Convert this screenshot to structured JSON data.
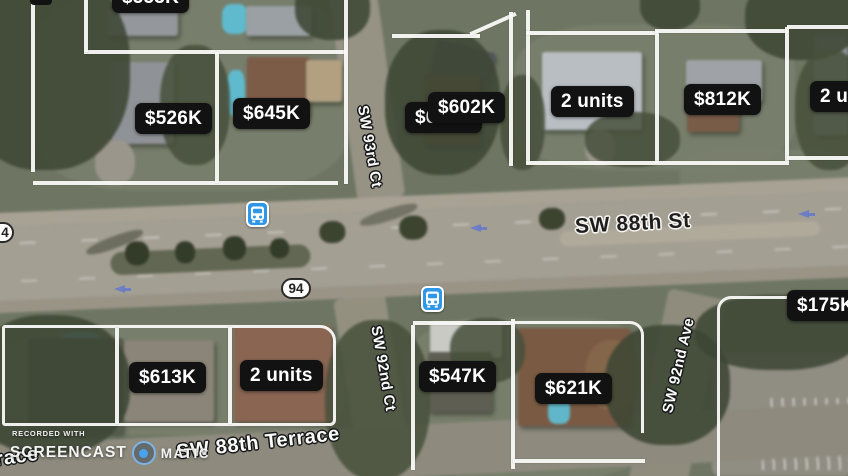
{
  "app": {
    "description": "real-estate satellite map with listing price pins"
  },
  "price_labels": [
    {
      "text": "$553K"
    },
    {
      "text": "$526K"
    },
    {
      "text": "$645K"
    },
    {
      "text": "$600K"
    },
    {
      "text": "$602K"
    },
    {
      "text": "2 units"
    },
    {
      "text": "$812K"
    },
    {
      "text": "2 units"
    },
    {
      "text": "$175K"
    },
    {
      "text": "$613K"
    },
    {
      "text": "2 units"
    },
    {
      "text": "$547K"
    },
    {
      "text": "$621K"
    }
  ],
  "streets": {
    "main_road": "SW 88th St",
    "terrace": "SW 88th Terrace",
    "terrace_partial": "Terrace",
    "ct93": "SW 93rd Ct",
    "ct92": "SW 92nd Ct",
    "ave92": "SW 92nd Ave"
  },
  "route_shields": {
    "main": "94",
    "partial": "4"
  },
  "transit": {
    "bus_stop_count": 2,
    "icon": "bus-icon"
  },
  "watermark": {
    "recorded_with": "RECORDED WITH",
    "brand_left": "SCREENCAST",
    "brand_right": "MATIC",
    "icon": "o-matic-circle-icon"
  },
  "colors": {
    "price_label_bg": "#121212",
    "price_label_text": "#ffffff",
    "transit_blue": "#2f97e8",
    "shield_bg": "#fcfcfb",
    "road_surface": "#a49f92",
    "street_text_dark": "#1e1e1e",
    "street_text_light": "#fbfbf9"
  }
}
